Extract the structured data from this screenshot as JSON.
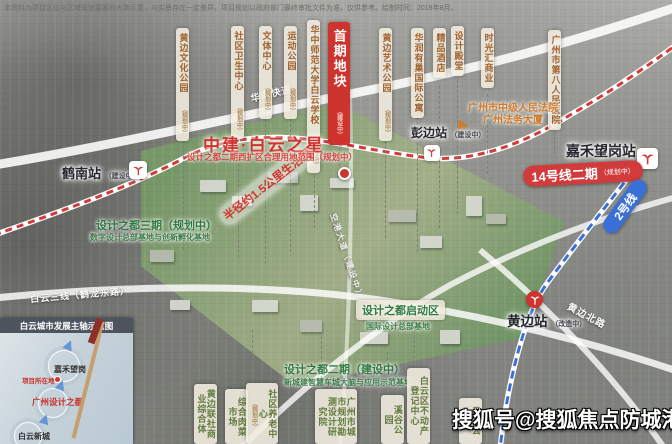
{
  "disclaimer": "本资料为项目区位与区域规划要素的大致示意，与实景存在一定差异，项目规划以政府部门最终审批文件为准，仅供参考。绘制时间：2019年8月。",
  "project": {
    "title": "中建·白云之星",
    "subtitle": "设计之都二期西扩区合理用地范围（规划中）",
    "first_plot": {
      "label": "首期地块",
      "sub": "（建设中）"
    }
  },
  "top_labels": [
    {
      "text": "黄边文化公园",
      "sub": "（规划中）"
    },
    {
      "text": "社区卫生中心",
      "sub": "（规划中）"
    },
    {
      "text": "文体中心",
      "sub": "（规划中）"
    },
    {
      "text": "运动公园",
      "sub": "（规划中）"
    },
    {
      "text": "华中师范大学白云学校",
      "sub": "（建设中）"
    },
    {
      "text": "黄边艺术公园",
      "sub": "（规划中）"
    },
    {
      "text": "华润有巢国际公寓",
      "sub": ""
    },
    {
      "text": "精品酒店",
      "sub": ""
    },
    {
      "text": "设计殿堂",
      "sub": ""
    },
    {
      "text": "时光汇商业",
      "sub": ""
    },
    {
      "text": "广州市第八人民医院",
      "sub": ""
    }
  ],
  "bottom_labels": [
    {
      "text": "黄边联社商业综合体",
      "sub": ""
    },
    {
      "text": "综合肉菜市场",
      "sub": ""
    },
    {
      "text": "社区养老中心",
      "sub": "（规划中）"
    },
    {
      "text": "广州市城市规划勘测设计研究院",
      "sub": ""
    },
    {
      "text": "溪谷公园",
      "sub": ""
    },
    {
      "text": "白云区不动产登记中心",
      "sub": ""
    },
    {
      "text": "云谷公园",
      "sub": ""
    }
  ],
  "stations": {
    "henan": {
      "name": "鹤南站",
      "sub": "（建设中）"
    },
    "pengbian": {
      "name": "彭边站",
      "sub": "（建设中）"
    },
    "jiahewanggang": {
      "name": "嘉禾望岗站",
      "sub": ""
    },
    "huangbian": {
      "name": "黄边站",
      "sub": "（改造中）"
    }
  },
  "metro": {
    "line14_badge": "14号线二期",
    "line14_sub": "（规划中）",
    "line14_color": "#d23b3b",
    "line2_badge": "2号线",
    "line2_color": "#3a6fd8"
  },
  "roads": {
    "huanan": "华南快速",
    "baiyun3": "白云三线（鹤龙东路）",
    "huangbianbei": "黄边北路",
    "konggang": "空港大道（建设中）"
  },
  "landmarks": {
    "court_line1": "广州市中级人民法院",
    "court_line2": "广州法务大厦"
  },
  "annotations": {
    "radius": "半径约1.5公里生活圈",
    "phase3_title": "设计之都三期（规划中）",
    "phase3_sub": "数字设计总部基地与创新孵化基地",
    "startzone_title": "设计之都启动区",
    "startzone_sub": "国际设计总部基地",
    "phase2_title": "设计之都二期（建设中）",
    "phase2_sub": "新城建智慧车城大脑与应用示范基地"
  },
  "inset": {
    "title": "白云城市发展主轴示意图",
    "nodes": {
      "jiahewanggang": "嘉禾望岗",
      "project_marker": "项目所在地",
      "design_city": "广州设计之都",
      "baiyun_newtown": "白云新城"
    }
  },
  "watermark": "搜狐号@搜狐焦点防城港站"
}
